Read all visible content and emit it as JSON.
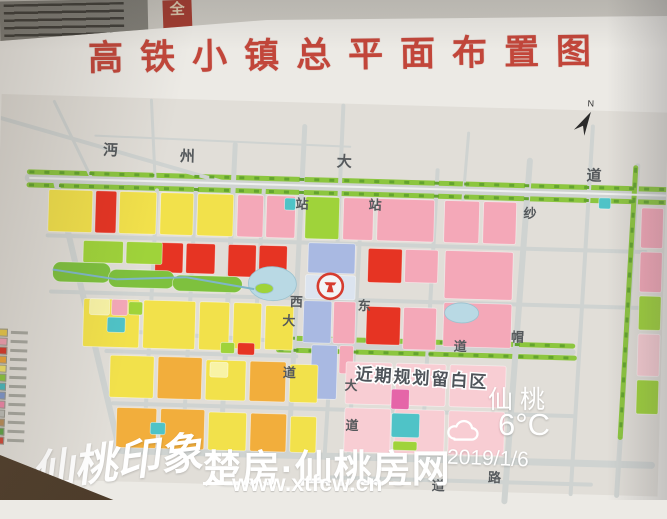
{
  "scene": {
    "posters": {
      "red_strip_char": "全"
    },
    "board": {
      "title": "高铁小镇总平面布置图"
    },
    "watermarks": {
      "calligraphy": "仙桃印象",
      "site_name": "楚房·仙桃房网",
      "site_url": "www.xtfcw.cn"
    },
    "weather": {
      "city": "仙桃",
      "temp": "6°C",
      "date": "2019/1/6",
      "icon": "cloud"
    },
    "map": {
      "blank_area_label": "近期规划留白区",
      "base_color": "#e1ded8",
      "road_color": "#cfd3d1",
      "label_color": "#55595c",
      "pond_color": "#b9d9e4",
      "station": {
        "x": 334,
        "y": 277
      },
      "north_arrow": {
        "x": 584,
        "y": 106
      },
      "roads": [
        [
          30,
          177,
          667,
          177,
          9
        ],
        [
          30,
          171,
          667,
          171,
          5,
          "#8cc63f"
        ],
        [
          30,
          184,
          667,
          184,
          5,
          "#8cc63f"
        ],
        [
          50,
          234,
          648,
          234,
          4
        ],
        [
          55,
          290,
          650,
          290,
          4
        ],
        [
          282,
          336,
          578,
          336,
          6
        ],
        [
          280,
          330,
          578,
          330,
          5,
          "#8cc63f"
        ],
        [
          284,
          342,
          580,
          342,
          5,
          "#8cc63f"
        ],
        [
          138,
          328,
          282,
          333,
          4
        ],
        [
          112,
          348,
          302,
          348,
          4
        ],
        [
          120,
          400,
          580,
          400,
          4
        ],
        [
          130,
          447,
          660,
          447,
          7
        ],
        [
          340,
          468,
          600,
          468,
          4
        ],
        [
          57,
          180,
          128,
          447,
          6
        ],
        [
          158,
          186,
          152,
          447,
          4
        ],
        [
          197,
          177,
          191,
          447,
          4
        ],
        [
          235,
          138,
          229,
          447,
          5
        ],
        [
          265,
          177,
          260,
          330,
          4
        ],
        [
          304,
          118,
          297,
          447,
          5
        ],
        [
          342,
          96,
          340,
          232,
          4
        ],
        [
          337,
          330,
          333,
          447,
          4
        ],
        [
          363,
          190,
          357,
          447,
          4
        ],
        [
          438,
          158,
          430,
          447,
          4
        ],
        [
          530,
          146,
          514,
          487,
          6
        ],
        [
          592,
          110,
          580,
          478,
          4
        ],
        [
          638,
          148,
          626,
          478,
          5
        ],
        [
          636,
          150,
          628,
          420,
          5,
          "#8cc63f"
        ],
        [
          0,
          118,
          228,
          177,
          4
        ],
        [
          53,
          100,
          93,
          177,
          3
        ],
        [
          150,
          96,
          156,
          177,
          3
        ],
        [
          95,
          133,
          350,
          137,
          2
        ],
        [
          468,
          120,
          464,
          190,
          3
        ]
      ],
      "tree_lines": [
        [
          30,
          171,
          667,
          171
        ],
        [
          30,
          184,
          667,
          184
        ],
        [
          280,
          330,
          578,
          330
        ],
        [
          284,
          342,
          580,
          342
        ],
        [
          636,
          150,
          628,
          420
        ]
      ],
      "blocks": [
        [
          50,
          188,
          44,
          42,
          "#f2e14b"
        ],
        [
          97,
          188,
          21,
          42,
          "#e63423"
        ],
        [
          121,
          188,
          37,
          42,
          "#f2e14b"
        ],
        [
          162,
          188,
          33,
          42,
          "#f2e14b"
        ],
        [
          199,
          188,
          36,
          42,
          "#f2e14b"
        ],
        [
          239,
          188,
          26,
          42,
          "#f4a8b8"
        ],
        [
          268,
          188,
          29,
          42,
          "#f4a8b8"
        ],
        [
          286,
          190,
          11,
          12,
          "#4fc3c7"
        ],
        [
          307,
          188,
          34,
          42,
          "#9fd33a"
        ],
        [
          345,
          188,
          30,
          42,
          "#f4a8b8"
        ],
        [
          379,
          188,
          57,
          42,
          "#f4a8b8"
        ],
        [
          446,
          188,
          35,
          42,
          "#f4a8b8"
        ],
        [
          485,
          188,
          33,
          42,
          "#f4a8b8"
        ],
        [
          600,
          181,
          12,
          11,
          "#4fc3c7"
        ],
        [
          643,
          190,
          22,
          40,
          "#f4a8b8"
        ],
        [
          643,
          234,
          22,
          40,
          "#f4a8b8"
        ],
        [
          643,
          278,
          22,
          34,
          "#9fd33a"
        ],
        [
          643,
          316,
          22,
          42,
          "#f8cdd3"
        ],
        [
          643,
          362,
          22,
          34,
          "#9fd33a"
        ],
        [
          158,
          238,
          28,
          30,
          "#e63423"
        ],
        [
          189,
          238,
          29,
          30,
          "#e63423"
        ],
        [
          231,
          238,
          28,
          32,
          "#e63423"
        ],
        [
          262,
          238,
          28,
          33,
          "#e63423"
        ],
        [
          86,
          238,
          40,
          22,
          "#9fd33a"
        ],
        [
          129,
          238,
          36,
          22,
          "#9fd33a"
        ],
        [
          56,
          260,
          58,
          20,
          "#7ec13e",
          8
        ],
        [
          112,
          266,
          66,
          18,
          "#7ec13e",
          8
        ],
        [
          176,
          270,
          70,
          16,
          "#7ec13e",
          8
        ],
        [
          311,
          234,
          47,
          30,
          "#a9b9e2"
        ],
        [
          309,
          266,
          50,
          24,
          "#dce4ef"
        ],
        [
          308,
          292,
          28,
          42,
          "#a9b9e2"
        ],
        [
          338,
          292,
          22,
          42,
          "#f4a8b8"
        ],
        [
          317,
          336,
          26,
          54,
          "#a9b9e2"
        ],
        [
          345,
          336,
          14,
          28,
          "#f4a8b8"
        ],
        [
          371,
          238,
          34,
          34,
          "#e63423"
        ],
        [
          408,
          238,
          33,
          33,
          "#f4a8b8"
        ],
        [
          448,
          238,
          68,
          48,
          "#f4a8b8"
        ],
        [
          88,
          296,
          56,
          48,
          "#f2e14b"
        ],
        [
          148,
          296,
          52,
          48,
          "#f2e14b"
        ],
        [
          204,
          296,
          30,
          48,
          "#f2e14b"
        ],
        [
          238,
          296,
          28,
          46,
          "#f2e14b"
        ],
        [
          270,
          298,
          28,
          44,
          "#f2e14b"
        ],
        [
          94,
          296,
          20,
          16,
          "#f8f3a6"
        ],
        [
          116,
          296,
          16,
          16,
          "#f4a8b8"
        ],
        [
          112,
          314,
          18,
          15,
          "#4fc3c7"
        ],
        [
          133,
          298,
          14,
          13,
          "#9fd33a"
        ],
        [
          371,
          296,
          34,
          38,
          "#e63423"
        ],
        [
          408,
          296,
          33,
          42,
          "#f4a8b8"
        ],
        [
          448,
          290,
          68,
          44,
          "#f4a8b8"
        ],
        [
          243,
          336,
          17,
          12,
          "#e63423"
        ],
        [
          226,
          336,
          14,
          11,
          "#9fd33a"
        ],
        [
          116,
          352,
          44,
          42,
          "#f2e14b"
        ],
        [
          164,
          352,
          44,
          42,
          "#f2ae3c"
        ],
        [
          212,
          354,
          40,
          40,
          "#f2e14b"
        ],
        [
          256,
          354,
          36,
          40,
          "#f2ae3c"
        ],
        [
          296,
          356,
          28,
          38,
          "#f2e14b"
        ],
        [
          216,
          356,
          18,
          15,
          "#f8f3a6"
        ],
        [
          124,
          404,
          40,
          40,
          "#f2ae3c"
        ],
        [
          168,
          404,
          44,
          40,
          "#f2ae3c"
        ],
        [
          216,
          406,
          38,
          38,
          "#f2e14b"
        ],
        [
          258,
          406,
          36,
          38,
          "#f2ae3c"
        ],
        [
          298,
          408,
          26,
          36,
          "#f2e14b"
        ],
        [
          158,
          418,
          15,
          12,
          "#4fc3c7"
        ],
        [
          352,
          352,
          46,
          42,
          "#f8cdd3"
        ],
        [
          402,
          352,
          50,
          42,
          "#f8cdd3"
        ],
        [
          456,
          352,
          56,
          42,
          "#f8cdd3"
        ],
        [
          352,
          398,
          46,
          44,
          "#f8cdd3"
        ],
        [
          402,
          398,
          50,
          44,
          "#f8cdd3"
        ],
        [
          456,
          398,
          56,
          44,
          "#f8cdd3"
        ],
        [
          398,
          378,
          18,
          20,
          "#e565a8"
        ],
        [
          399,
          402,
          28,
          24,
          "#4fc3c7"
        ],
        [
          401,
          430,
          24,
          9,
          "#9fd33a"
        ]
      ],
      "ponds": [
        [
          276,
          276,
          24,
          17
        ],
        [
          466,
          300,
          17,
          10
        ],
        [
          268,
          281,
          9,
          5,
          "#9fd33a"
        ]
      ],
      "overlines": [
        [
          56,
          268,
          120,
          276,
          2,
          "#7fb6c9"
        ],
        [
          120,
          276,
          190,
          272,
          2,
          "#7fb6c9"
        ],
        [
          190,
          272,
          258,
          282,
          2,
          "#7fb6c9"
        ],
        [
          30,
          177,
          667,
          177,
          2,
          "#eef0ee"
        ]
      ],
      "labels": [
        [
          "沔",
          103,
          152,
          15
        ],
        [
          "州",
          180,
          156,
          15
        ],
        [
          "大",
          337,
          157,
          15
        ],
        [
          "道",
          587,
          164,
          15
        ],
        [
          "站",
          297,
          200,
          13
        ],
        [
          "站",
          370,
          199,
          13
        ],
        [
          "西",
          294,
          298,
          13
        ],
        [
          "东",
          362,
          300,
          13
        ],
        [
          "大",
          287,
          317,
          13
        ],
        [
          "道",
          289,
          369,
          13
        ],
        [
          "大",
          351,
          380,
          13
        ],
        [
          "道",
          353,
          420,
          13
        ],
        [
          "纱",
          525,
          203,
          13
        ],
        [
          "帽",
          516,
          327,
          13
        ],
        [
          "路",
          497,
          468,
          13
        ],
        [
          "道",
          459,
          338,
          13
        ],
        [
          "道",
          441,
          478,
          13
        ]
      ],
      "legend_colors": [
        "#e8c84a",
        "#f0a0b0",
        "#d8392b",
        "#eda53c",
        "#f0e26a",
        "#8cc63f",
        "#49b8bd",
        "#7f97cc",
        "#ef86a8",
        "#bcbcb6",
        "#b98d5a",
        "#5fa348",
        "#cf4a3a"
      ]
    }
  }
}
